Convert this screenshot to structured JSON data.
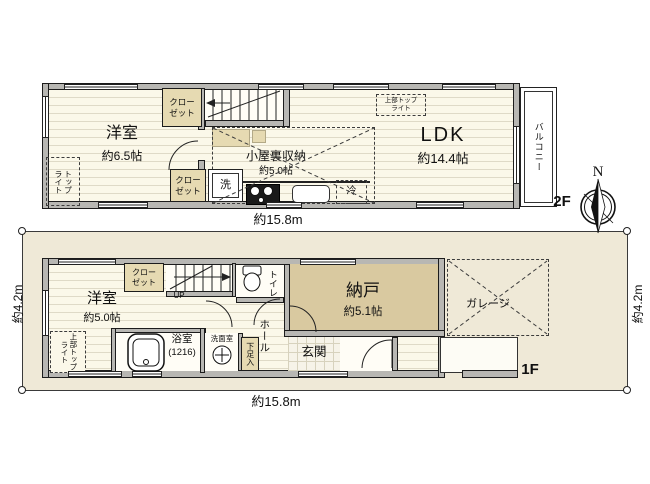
{
  "compass": {
    "north": "N"
  },
  "dims": {
    "top_width": "約15.8m",
    "bottom_width": "約15.8m",
    "left_height": "約4.2m",
    "right_height": "約4.2m"
  },
  "f2": {
    "label": "2F",
    "west_room_name": "洋室",
    "west_room_size": "約6.5帖",
    "ldk_name": "LDK",
    "ldk_size": "約14.4帖",
    "attic_name": "小屋裏収納",
    "attic_size": "約5.0帖",
    "closet_top": "クロー\nゼット",
    "closet_bottom": "クロー\nゼット",
    "washer": "洗",
    "fridge": "冷",
    "balcony": "バルコニー",
    "toplight": "トップ\nライト",
    "upper_toplight": "上部トップ\nライト"
  },
  "f1": {
    "label": "1F",
    "west_room_name": "洋室",
    "west_room_size": "約5.0帖",
    "closet": "クロー\nゼット",
    "up": "UP",
    "toilet": "トイレ",
    "bath_name": "浴室",
    "bath_size": "(1216)",
    "washroom": "洗面室",
    "hall": "ホール",
    "shoe": "下足入",
    "nando_name": "納戸",
    "nando_size": "約5.1帖",
    "entrance": "玄関",
    "garage": "ガレージ",
    "upper_toplight": "上部トップ\nライト"
  }
}
